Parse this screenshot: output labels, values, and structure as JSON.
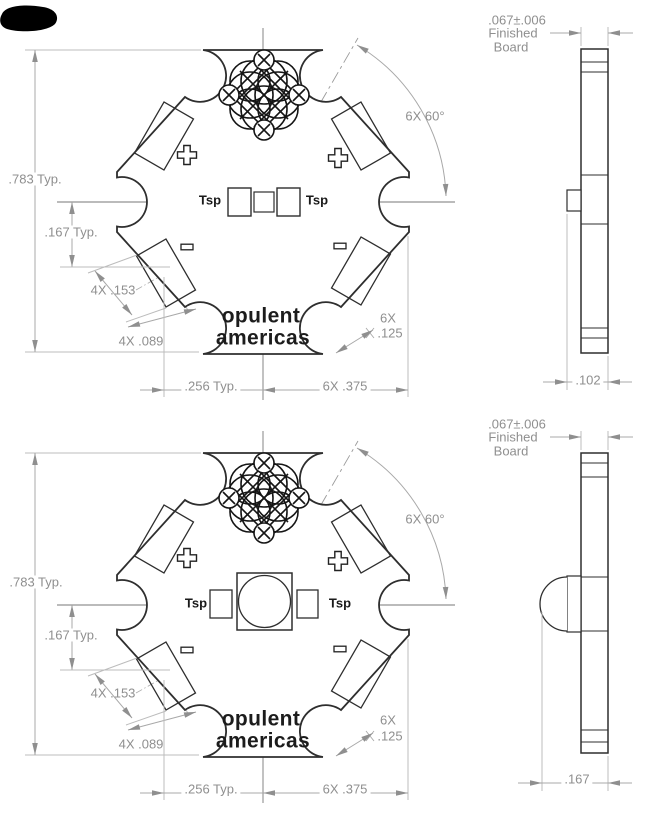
{
  "meta": {
    "background_color": "#ffffff",
    "outline_color": "#2e2e2e",
    "dimension_color": "#8f8f8f",
    "drawing_type": "star MCPCB mechanical drawing, two sheets (bare board and board with LED)"
  },
  "top_view": {
    "dims": {
      "height": ".783 Typ.",
      "center_offset": ".167 Typ.",
      "pad_length": "4X .153",
      "pad_width": "4X .089",
      "pitch": ".256 Typ.",
      "point_spacing": "6X .375",
      "angle": "6X 60°",
      "notch_count": "6X",
      "notch_radius": ".125"
    },
    "labels": {
      "tsp_left": "Tsp",
      "tsp_right": "Tsp",
      "logo_line1": "opulent",
      "logo_line2": "americas",
      "positive_mark": "+",
      "negative_mark": "−"
    },
    "profile": {
      "thickness_line1": ".067±.006",
      "thickness_line2": "Finished",
      "thickness_line3": "Board",
      "overall_thickness": ".102"
    }
  },
  "bottom_view": {
    "dims": {
      "height": ".783 Typ.",
      "center_offset": ".167 Typ.",
      "pad_length": "4X .153",
      "pad_width": "4X .089",
      "pitch": ".256 Typ.",
      "point_spacing": "6X .375",
      "angle": "6X 60°",
      "notch_count": "6X",
      "notch_radius": ".125"
    },
    "labels": {
      "tsp_left": "Tsp",
      "tsp_right": "Tsp",
      "logo_line1": "opulent",
      "logo_line2": "americas",
      "positive_mark": "+",
      "negative_mark": "−"
    },
    "profile": {
      "thickness_line1": ".067±.006",
      "thickness_line2": "Finished",
      "thickness_line3": "Board",
      "overall_thickness": ".167"
    }
  }
}
